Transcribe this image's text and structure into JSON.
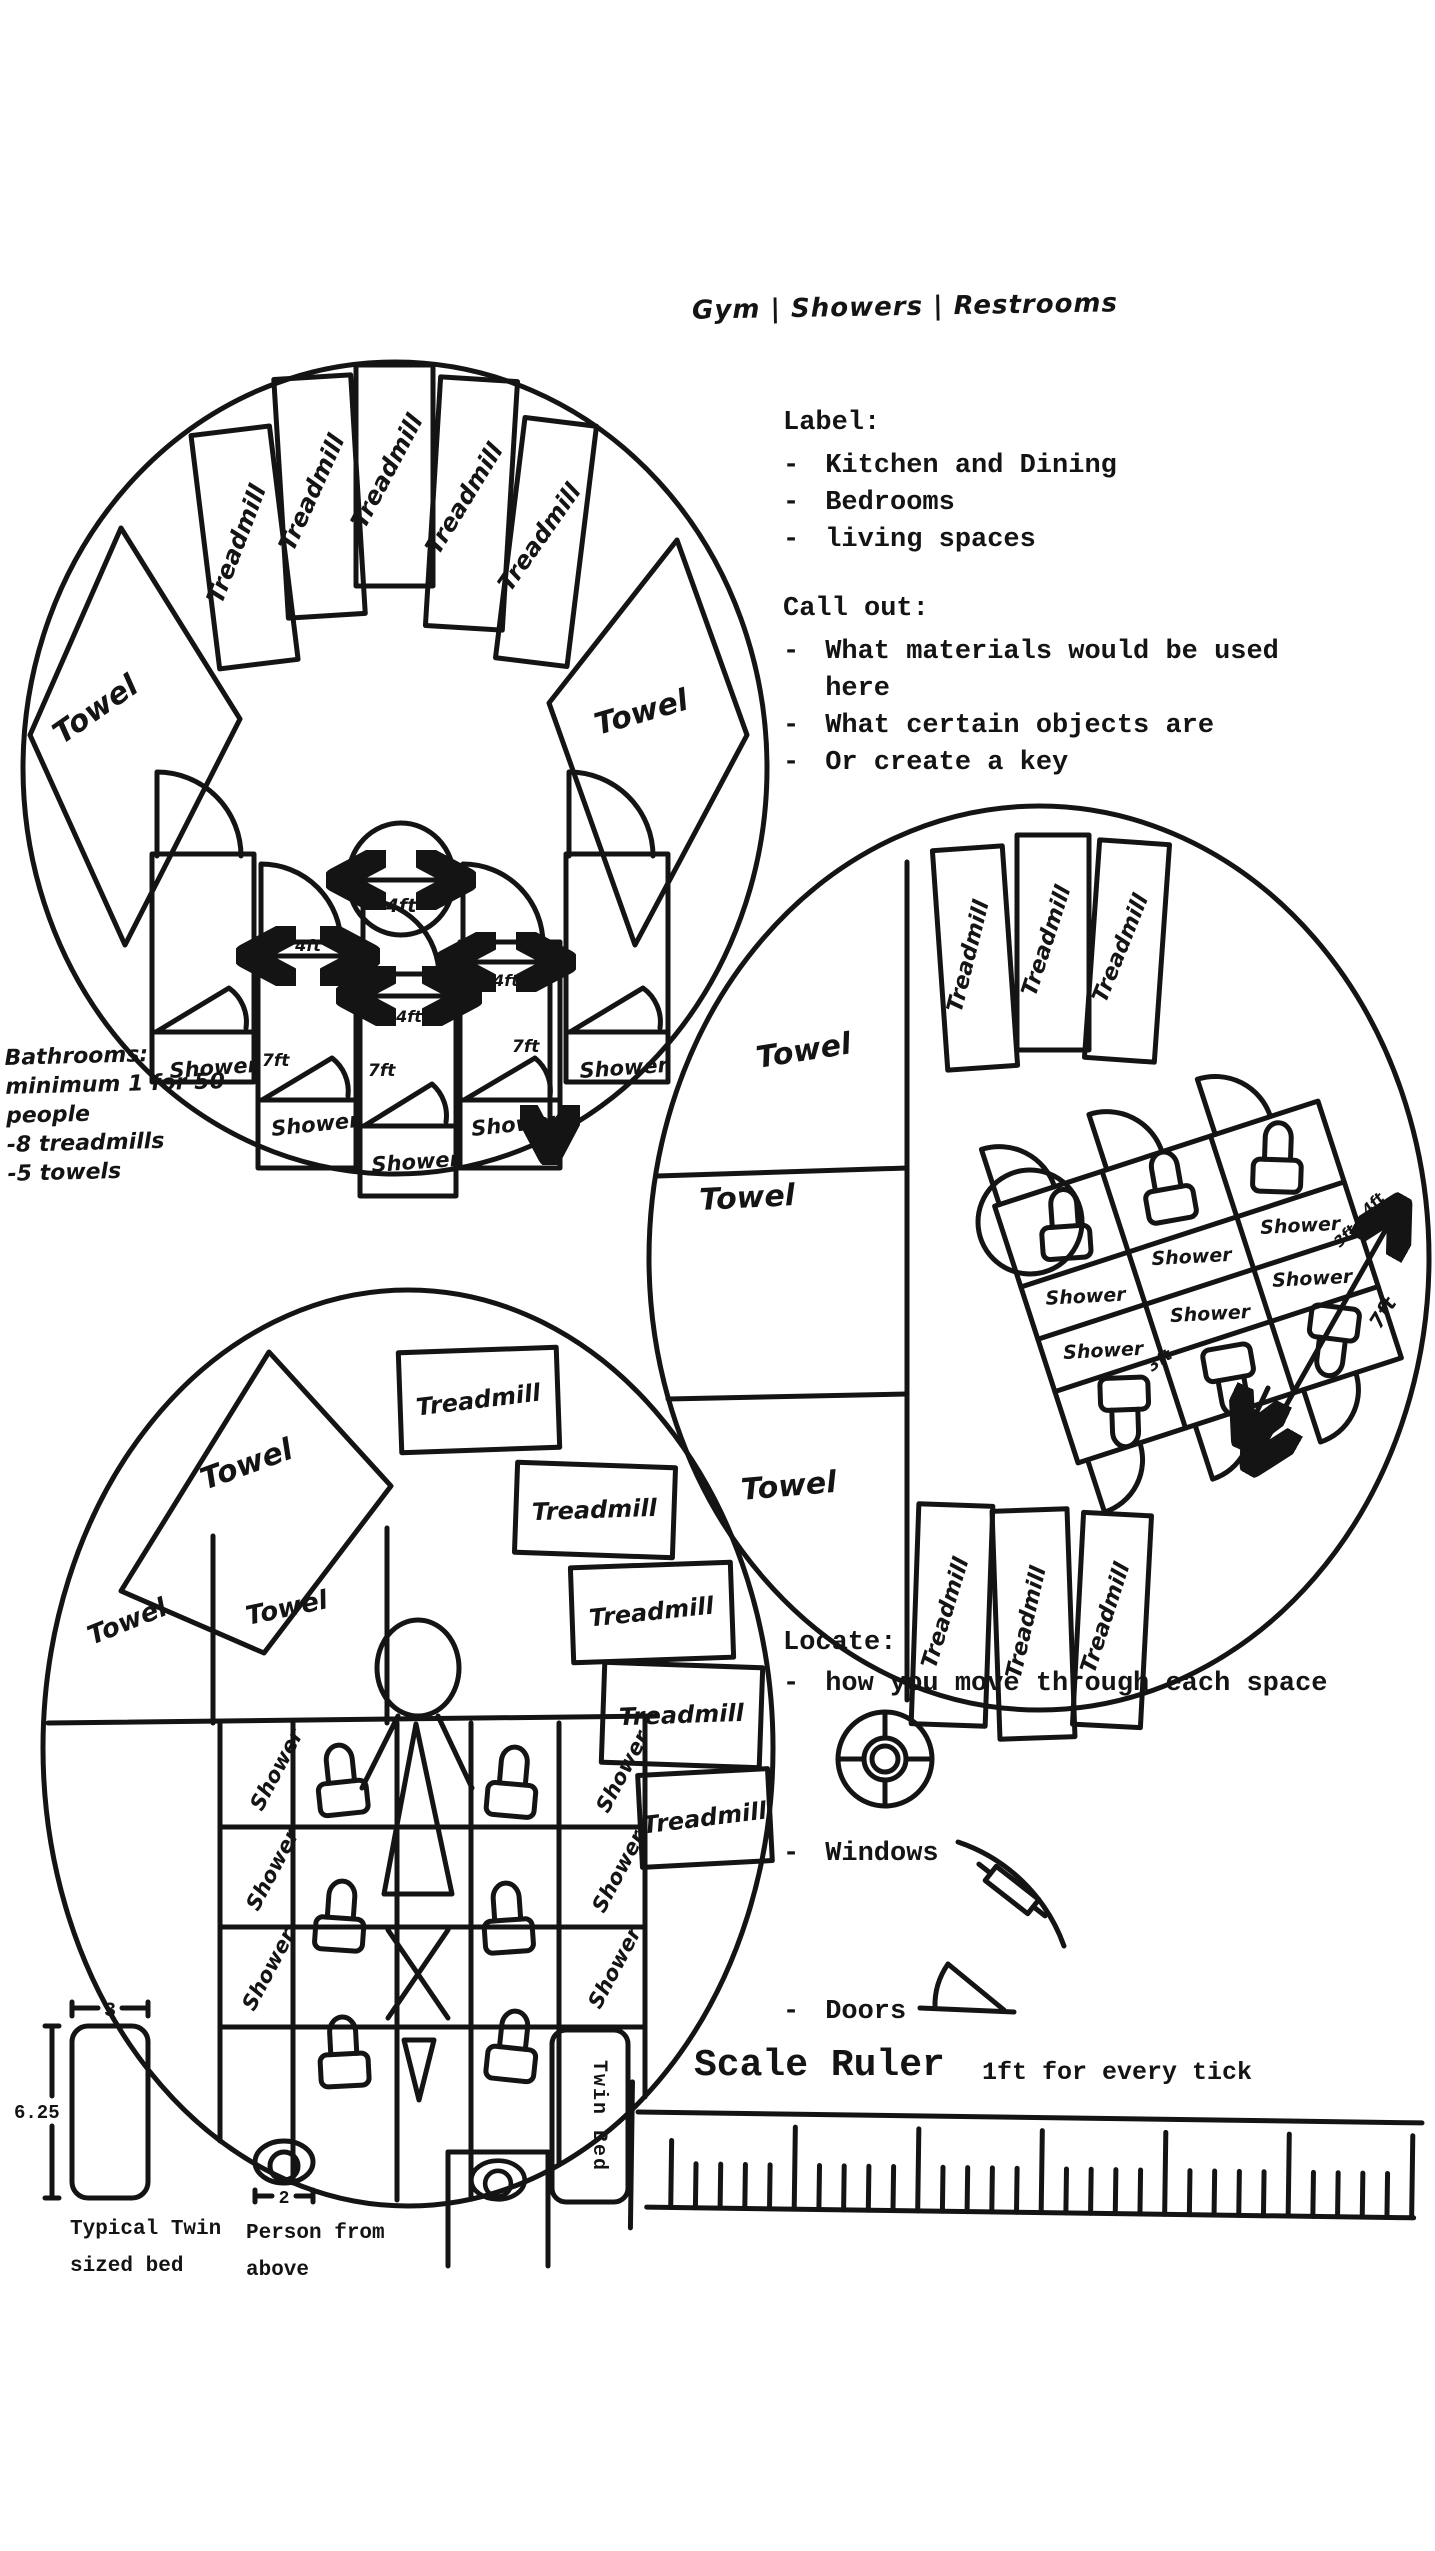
{
  "bullet": "-",
  "title": "Gym | Showers | Restrooms",
  "sections": {
    "label": {
      "heading": "Label:",
      "items": [
        "Kitchen and Dining",
        "Bedrooms",
        "living spaces"
      ]
    },
    "callout": {
      "heading": "Call out:",
      "items": [
        "What materials would be used here",
        "What certain objects are",
        "Or create a key"
      ]
    },
    "locate": {
      "heading": "Locate:",
      "items": [
        "how you move through each space",
        "Windows",
        "Doors"
      ]
    }
  },
  "notes": {
    "heading": "Bathrooms:",
    "line2": "minimum 1 for 50 people",
    "line3": "-8 treadmills",
    "line4": "-5 towels"
  },
  "labels": {
    "treadmill": "Treadmill",
    "towel": "Towel",
    "shower": "Shower"
  },
  "dims": {
    "ft4": "4ft",
    "ft7": "7ft",
    "ft3": "3ft"
  },
  "legend": {
    "bed_width": "3",
    "bed_length": "6.25",
    "person_width": "2",
    "bed_caption": "Typical Twin sized bed",
    "person_caption": "Person from above",
    "twin_bed": "Twin Bed"
  },
  "ruler": {
    "title": "Scale Ruler",
    "subtitle": "1ft for every tick"
  },
  "ink": "#141414",
  "paper": "#ffffff"
}
